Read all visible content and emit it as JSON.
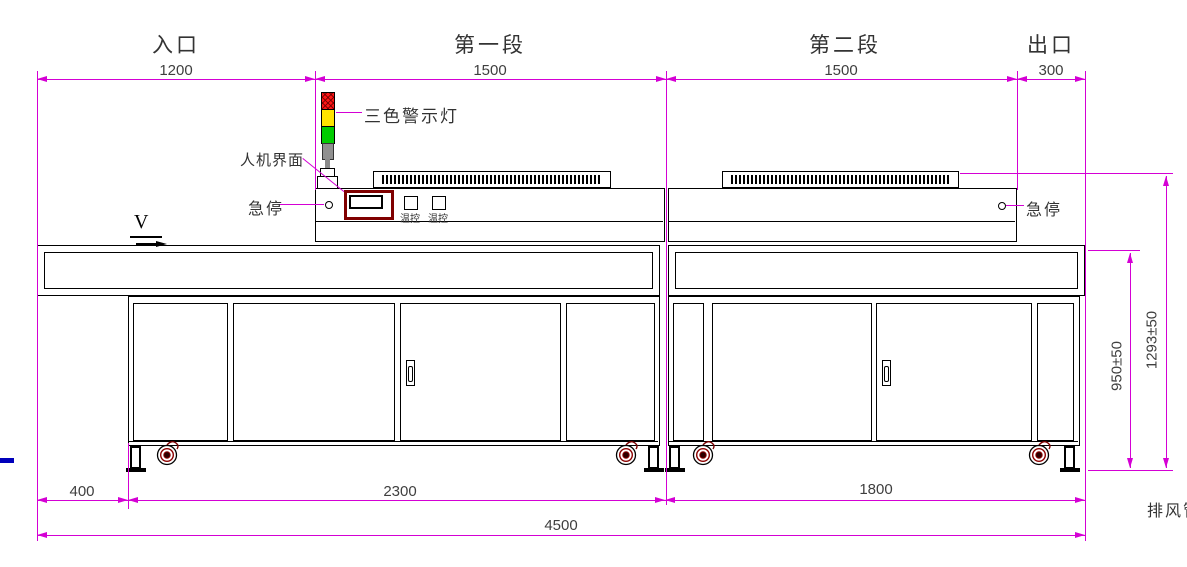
{
  "drawing": {
    "top": {
      "sections": [
        {
          "label": "入口",
          "dim": "1200"
        },
        {
          "label": "第一段",
          "dim": "1500"
        },
        {
          "label": "第二段",
          "dim": "1500"
        },
        {
          "label": "出口",
          "dim": "300"
        }
      ]
    },
    "bottom": {
      "dims": [
        "400",
        "2300",
        "1800",
        "4500"
      ]
    },
    "right": {
      "dims": [
        "950±50",
        "1293±50"
      ]
    },
    "labels": {
      "warning_light": "三色警示灯",
      "hmi": "人机界面",
      "estop_left": "急停",
      "estop_right": "急停",
      "temp_controller_1": "温控",
      "temp_controller_2": "温控",
      "exhaust_duct": "排风管",
      "conveyor_direction": "V"
    },
    "colors": {
      "dimension_line": "#d400d4",
      "outline": "#000000",
      "warning_red": "#ff1515",
      "warning_yellow": "#ffe400",
      "warning_green": "#00cc00",
      "hmi_bezel": "#800000",
      "caster": "#8b0000",
      "stray_mark_blue": "#0000bb"
    }
  }
}
